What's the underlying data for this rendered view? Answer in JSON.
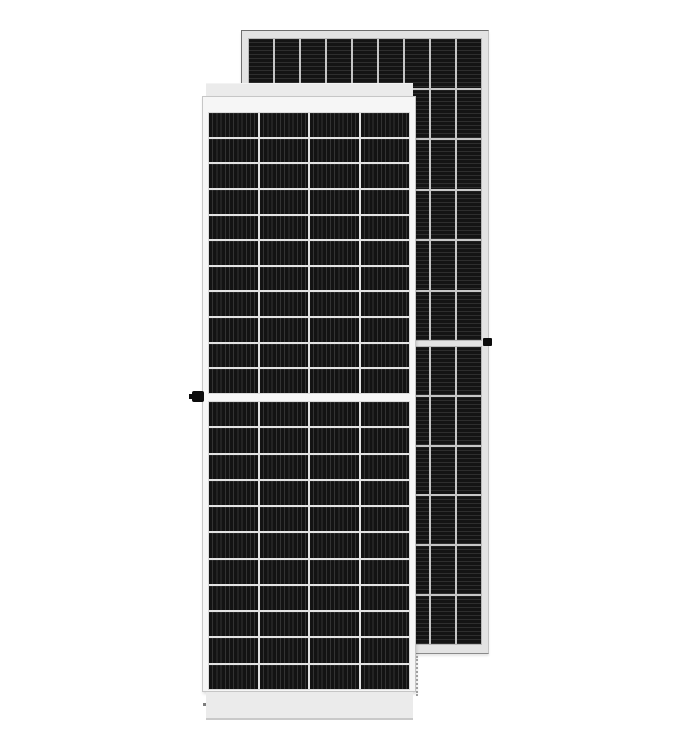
{
  "scene": {
    "label": "Product photo of two framed monocrystalline half-cut solar panels, one in front and one behind offset to the upper right",
    "background_color": "#ffffff"
  },
  "front_panel": {
    "label": "Front solar panel, portrait, white frame, half-cut cell layout",
    "columns": 4,
    "rows_top_half": 11,
    "rows_bottom_half": 11,
    "stripe_direction": "vertical",
    "frame_color": "#f6f6f6",
    "cap_color": "#ebebeb",
    "cell_color": "#131313",
    "stripe_color": "#333333",
    "separator_color": "#e3e3e3",
    "clip_side": "left"
  },
  "back_panel": {
    "label": "Rear solar panel, portrait, light gray frame, narrow cell columns with horizontal ribbing",
    "columns": 9,
    "rows_top_half": 6,
    "rows_bottom_half": 6,
    "stripe_direction": "horizontal",
    "frame_color": "#e3e3e3",
    "cell_color": "#141414",
    "stripe_color": "#2e2e2e",
    "separator_color": "#c6c6c6",
    "clip_side": "right"
  }
}
